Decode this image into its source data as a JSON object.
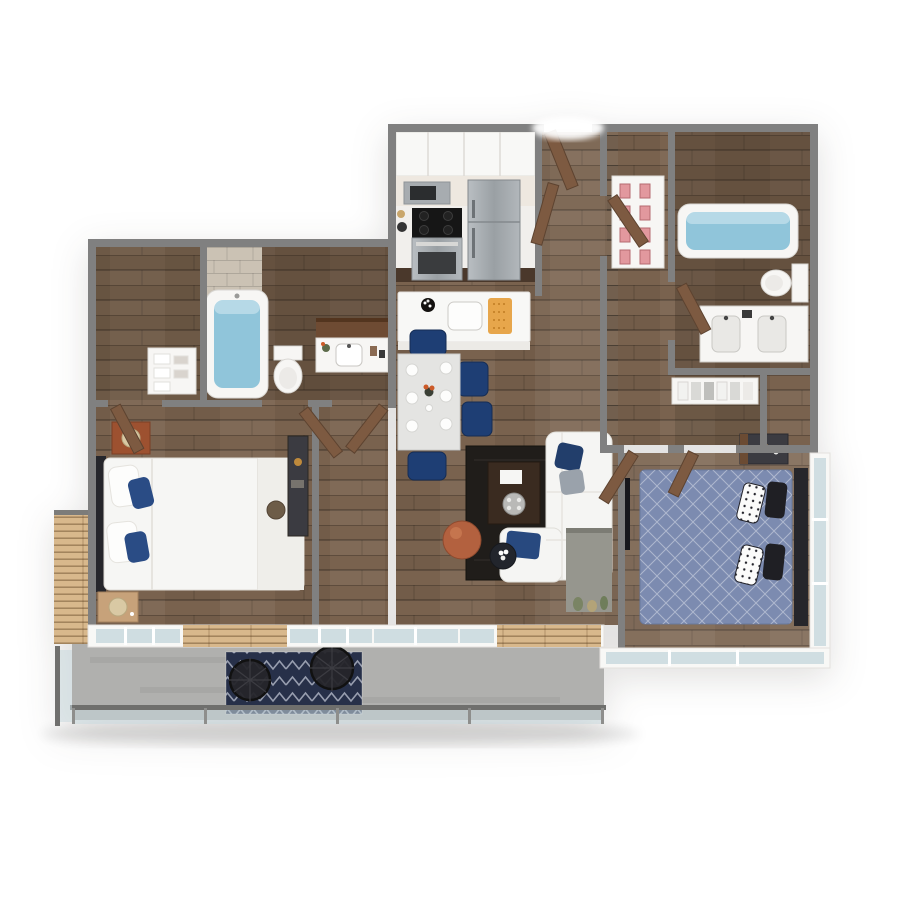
{
  "scene": {
    "title": "3D apartment floor plan rendering",
    "style": "top-down dollhouse 3D render, two-bedroom two-bath unit with balcony",
    "background": "#ffffff"
  },
  "palette": {
    "wall_top": "#808080",
    "wall_face": "#f8f8f6",
    "wood_floor": "#79624e",
    "door_brown": "#7d5a41",
    "accent_wall_brown": "#6e4b33",
    "tile_beige": "#cbc2b4",
    "tub_water": "#90c5da",
    "fixture_white": "#f7f6f4",
    "counter_white": "#f1efec",
    "cabinet_dark_wood": "#4a382b",
    "stainless_steel": "#a7acb0",
    "island_white": "#f8f8f6",
    "dining_chair_navy": "#1e3e74",
    "pillow_navy": "#2a4c85",
    "sofa_white": "#f5f5f3",
    "rug_dark": "#201d1a",
    "pouf_terracotta": "#b3613f",
    "side_table_black": "#22252c",
    "tv_black": "#17171c",
    "media_wall_gray": "#96968e",
    "bed2_duvet_blue": "#7c8bb0",
    "headboard_charcoal": "#26262b",
    "nightstand_rust": "#9d5130",
    "nightstand_wood": "#c7a27a",
    "furniture_charcoal": "#3b3b41",
    "lamp_shade_tan": "#d9c9a4",
    "shoe_pink": "#e2989e",
    "balcony_concrete": "#b0b0ae",
    "railing_gray": "#6f6f6d",
    "glass_blue": "#c9d9de",
    "slat_wood_tan": "#d8b88c",
    "rug_balcony_navy": "#273049",
    "orange_board": "#e7a64b",
    "flower_orange": "#cc5a28"
  },
  "rooms": [
    {
      "label": "Kitchen",
      "furniture": [
        "upper cabinets",
        "microwave",
        "range with cooktop",
        "stainless refrigerator",
        "island with sink",
        "orange cutting board"
      ]
    },
    {
      "label": "Dining Area",
      "furniture": [
        "dining table",
        "six place settings",
        "flower vase",
        "navy upholstered chairs"
      ]
    },
    {
      "label": "Living Room",
      "furniture": [
        "white sectional sofa",
        "navy and gray pillows",
        "dark area rug",
        "coffee table with tray",
        "terracotta pouf",
        "round side table with flowers",
        "gray media accent wall",
        "wall TV"
      ]
    },
    {
      "label": "Entry Hall",
      "furniture": [
        "entry door",
        "hall doors"
      ]
    },
    {
      "label": "Bedroom 1",
      "furniture": [
        "bed with white duvet and navy pillows",
        "rust nightstand with lamp",
        "wood nightstand with lamp",
        "console desk with stool"
      ]
    },
    {
      "label": "Bathroom 1",
      "furniture": [
        "bathtub",
        "toilet",
        "vanity with sink",
        "tile accent wall"
      ]
    },
    {
      "label": "Linen Closet",
      "furniture": [
        "shelving with towels"
      ]
    },
    {
      "label": "Hallway",
      "furniture": [
        "shoe shelf with pink shoes"
      ]
    },
    {
      "label": "Bathroom 2",
      "furniture": [
        "bathtub",
        "toilet",
        "double-sink vanity"
      ]
    },
    {
      "label": "Walk-in Closet",
      "furniture": [
        "hanging clothes rod"
      ]
    },
    {
      "label": "Bedroom 2",
      "furniture": [
        "bed with blue quilted duvet",
        "black and white pillows",
        "charcoal nightstand",
        "glass window walls"
      ]
    },
    {
      "label": "Balcony",
      "furniture": [
        "concrete deck",
        "glass railing",
        "navy patterned outdoor rug",
        "two black wire lounge chairs",
        "wood slat cladding"
      ]
    }
  ]
}
